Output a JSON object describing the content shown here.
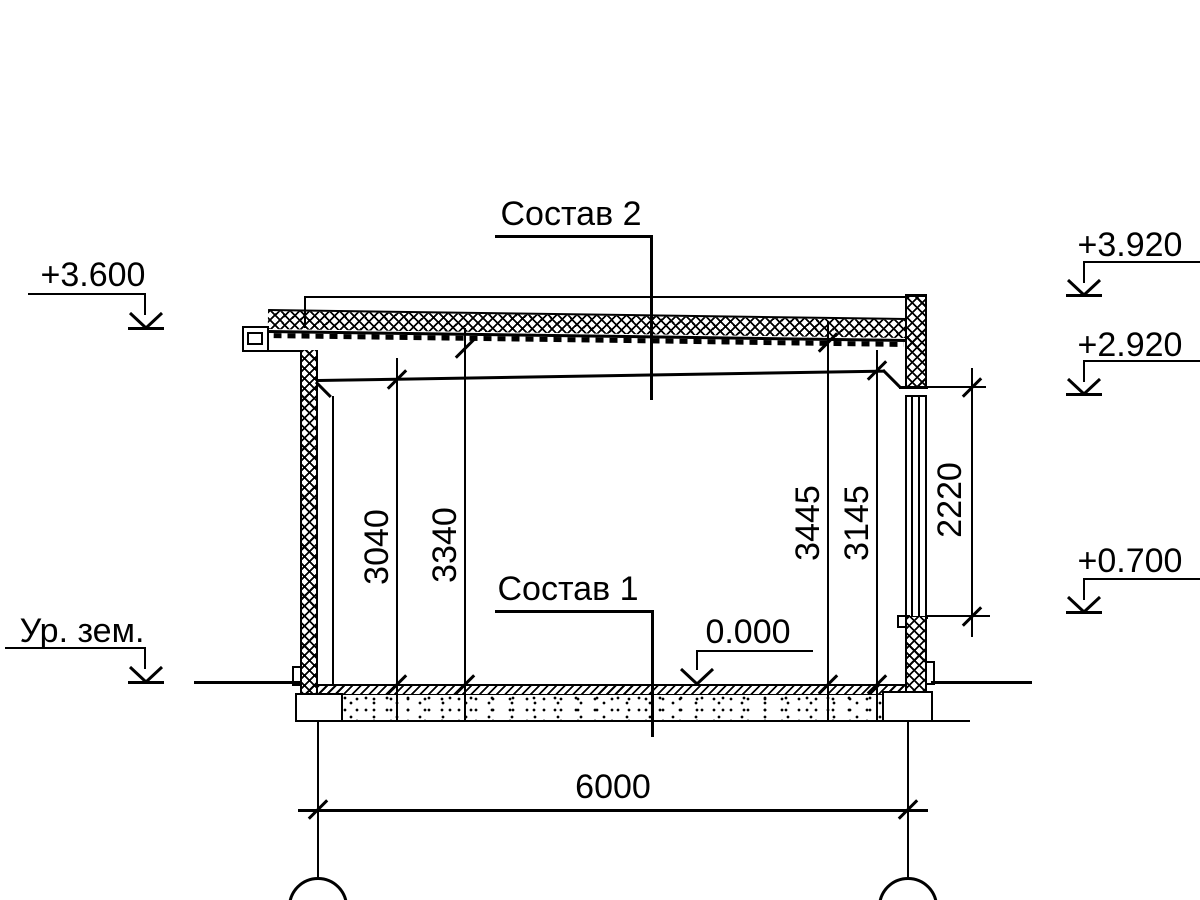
{
  "labels": {
    "composition_2": "Состав 2",
    "composition_1": "Состав 1",
    "ground_level": "Ур. зем."
  },
  "elevations": {
    "roof_edge": "+3.600",
    "parapet_top": "+3.920",
    "window_head": "+2.920",
    "window_sill": "+0.700",
    "floor_zero": "0.000"
  },
  "dimensions": {
    "clear_height_left": "3040",
    "deck_height_left": "3340",
    "deck_height_right": "3445",
    "clear_height_right": "3145",
    "window_height": "2220",
    "span": "6000"
  },
  "colors": {
    "line": "#000000",
    "background": "#ffffff"
  }
}
